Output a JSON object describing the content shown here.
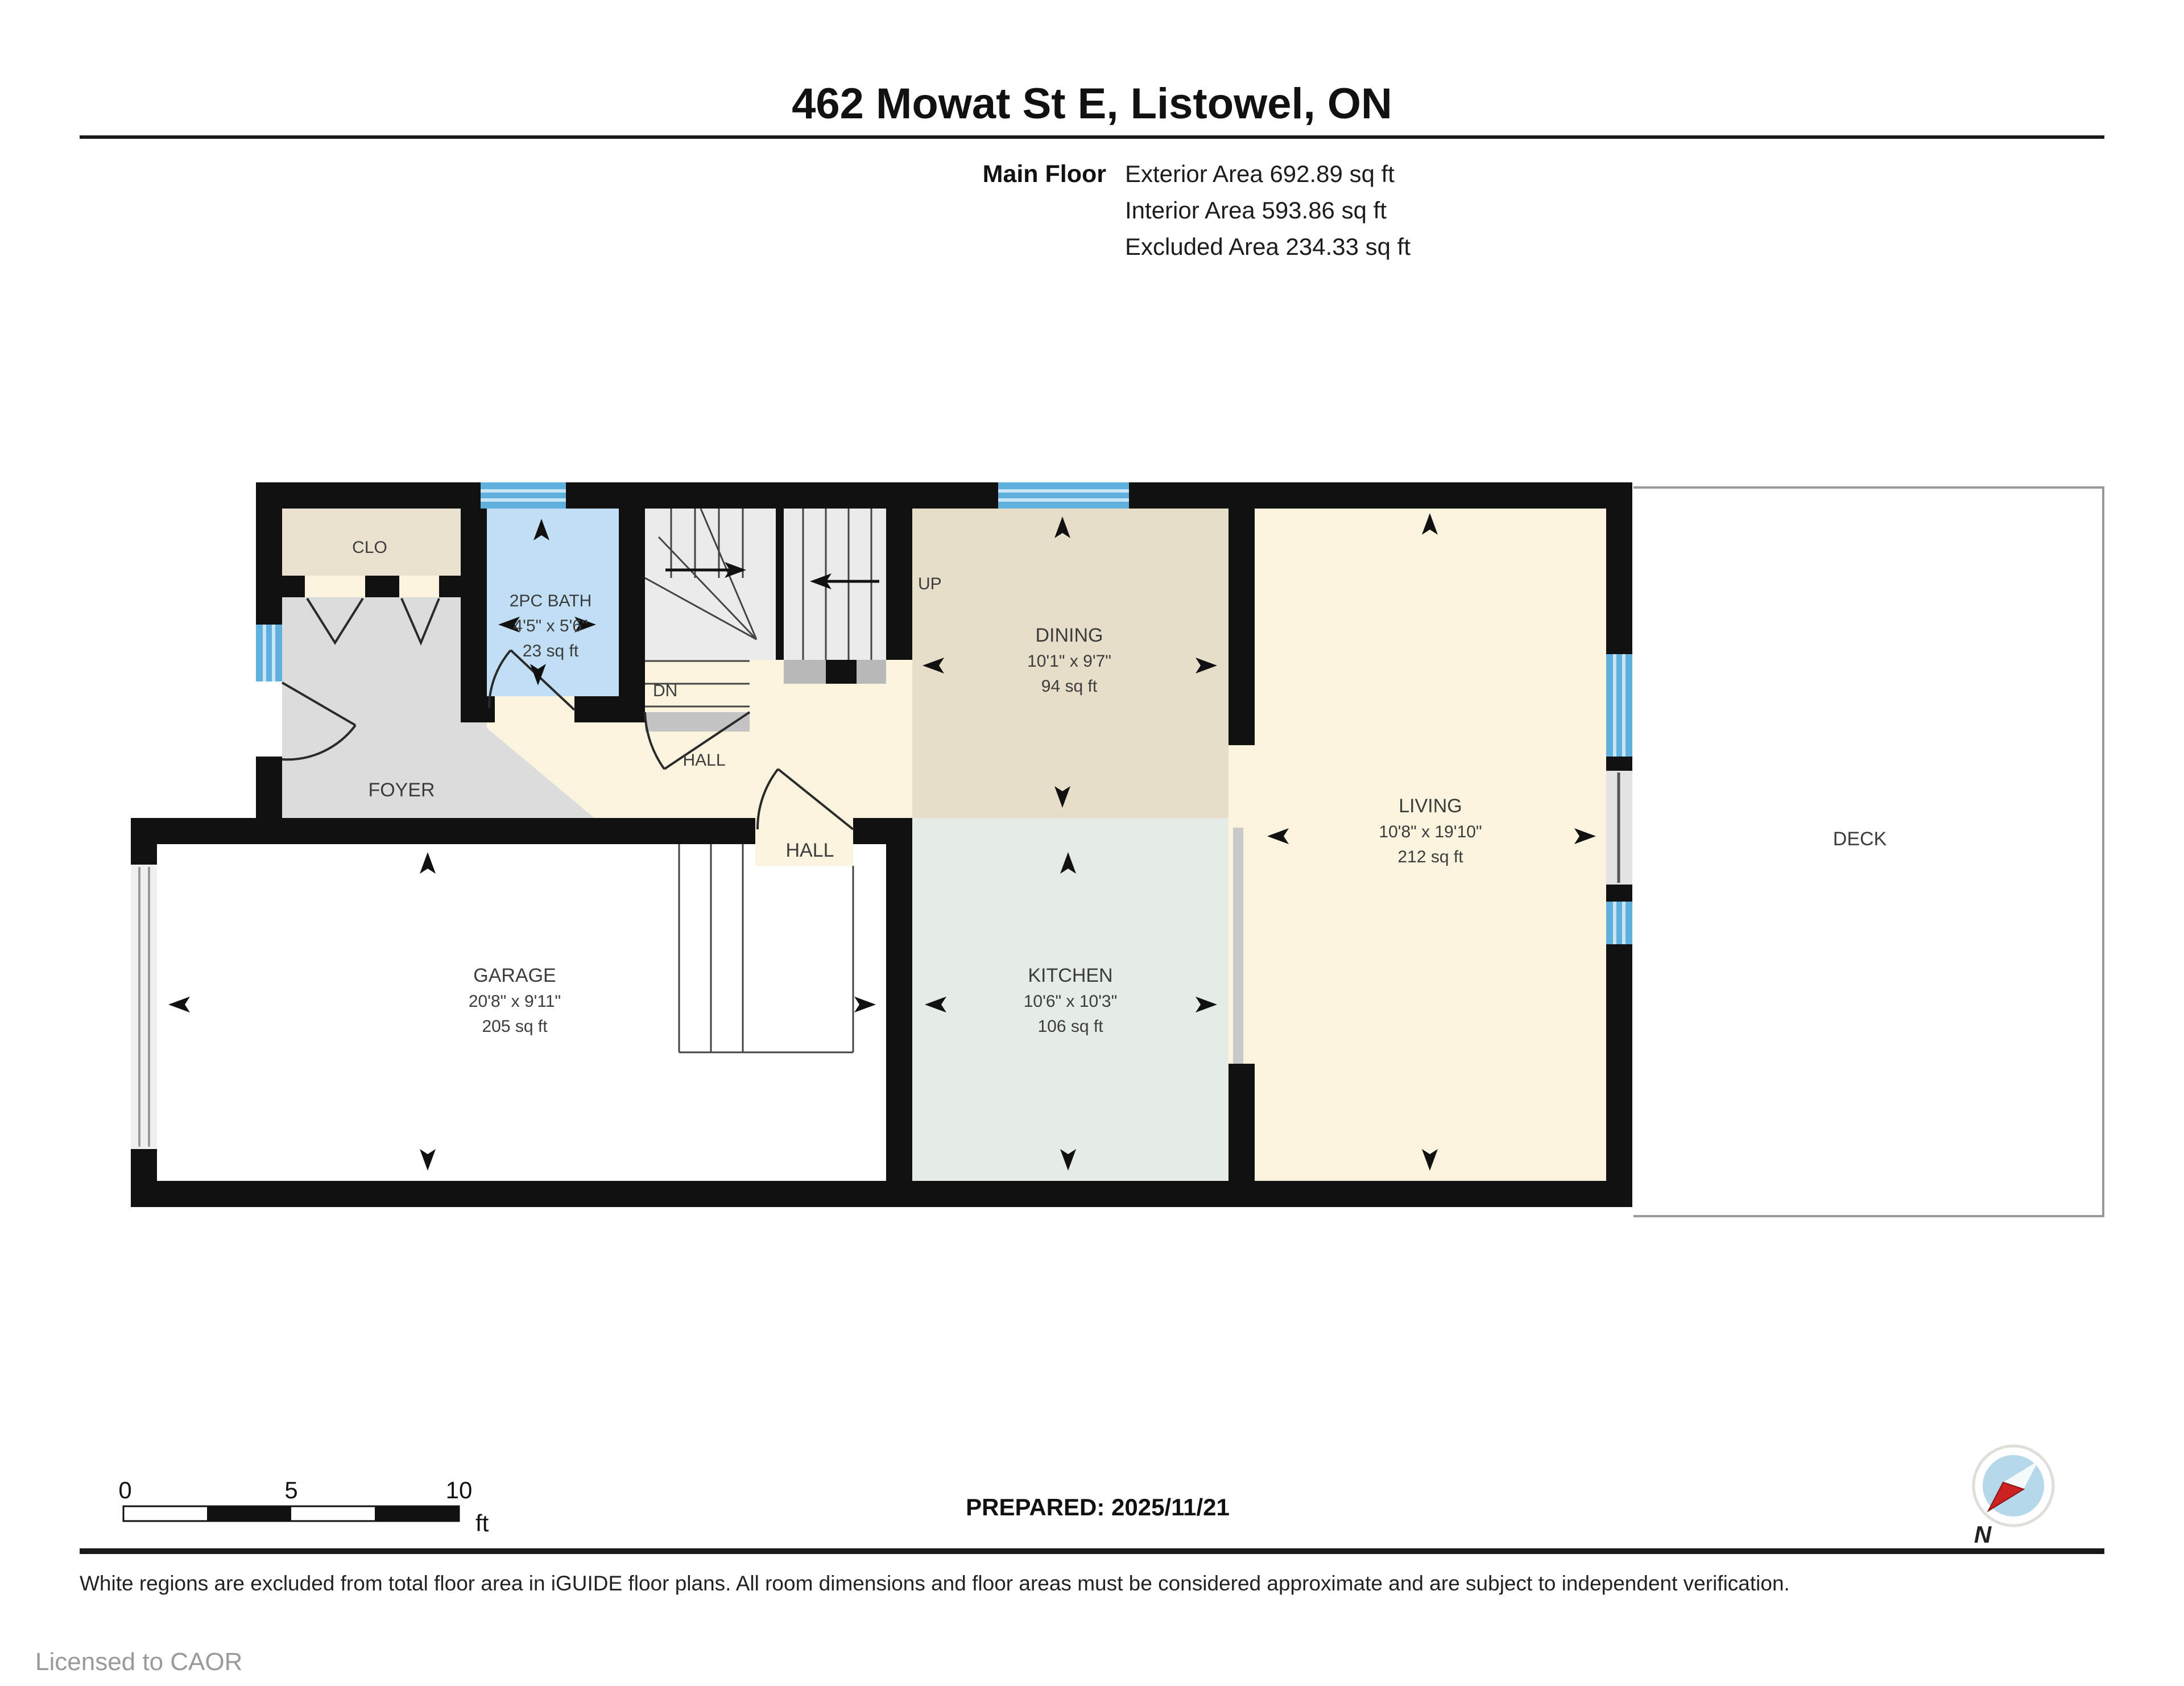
{
  "title": "462 Mowat St E, Listowel, ON",
  "floor_info": {
    "label": "Main Floor",
    "lines": [
      "Exterior Area 692.89 sq ft",
      "Interior Area 593.86 sq ft",
      "Excluded Area 234.33 sq ft"
    ]
  },
  "rooms": {
    "clo": {
      "name": "CLO"
    },
    "bath": {
      "name": "2PC BATH",
      "dims": "4'5\" x 5'6\"",
      "area": "23 sq ft"
    },
    "foyer": {
      "name": "FOYER"
    },
    "hall_small": {
      "name": "HALL"
    },
    "hall": {
      "name": "HALL"
    },
    "dining": {
      "name": "DINING",
      "dims": "10'1\" x 9'7\"",
      "area": "94 sq ft"
    },
    "living": {
      "name": "LIVING",
      "dims": "10'8\" x 19'10\"",
      "area": "212 sq ft"
    },
    "kitchen": {
      "name": "KITCHEN",
      "dims": "10'6\" x 10'3\"",
      "area": "106 sq ft"
    },
    "garage": {
      "name": "GARAGE",
      "dims": "20'8\" x 9'11\"",
      "area": "205 sq ft"
    },
    "deck": {
      "name": "DECK"
    }
  },
  "stairs": {
    "up": "UP",
    "dn": "DN"
  },
  "scale_bar": {
    "t0": "0",
    "t5": "5",
    "t10": "10",
    "unit": "ft"
  },
  "prepared": "PREPARED: 2025/11/21",
  "disclaimer": "White regions are excluded from total floor area in iGUIDE floor plans. All room dimensions and floor areas must be considered approximate and are subject to independent verification.",
  "license": "Licensed to CAOR",
  "compass": {
    "north": "N"
  },
  "colors": {
    "wall": "#111111",
    "window_blue": "#5fb0dd",
    "window_stripe": "#c9e6f6",
    "bath_blue": "#c1dff4",
    "dining_tan": "#e7dec9",
    "clo_tan": "#eae2cf",
    "cream": "#faf3dd",
    "foyer_gray": "#dcdcdc",
    "kitchen_mint": "#e5ece6",
    "stair_gray": "#ebebeb",
    "deck_border": "#999999",
    "compass_red": "#cc2222",
    "compass_blue": "#b5d8ea"
  }
}
